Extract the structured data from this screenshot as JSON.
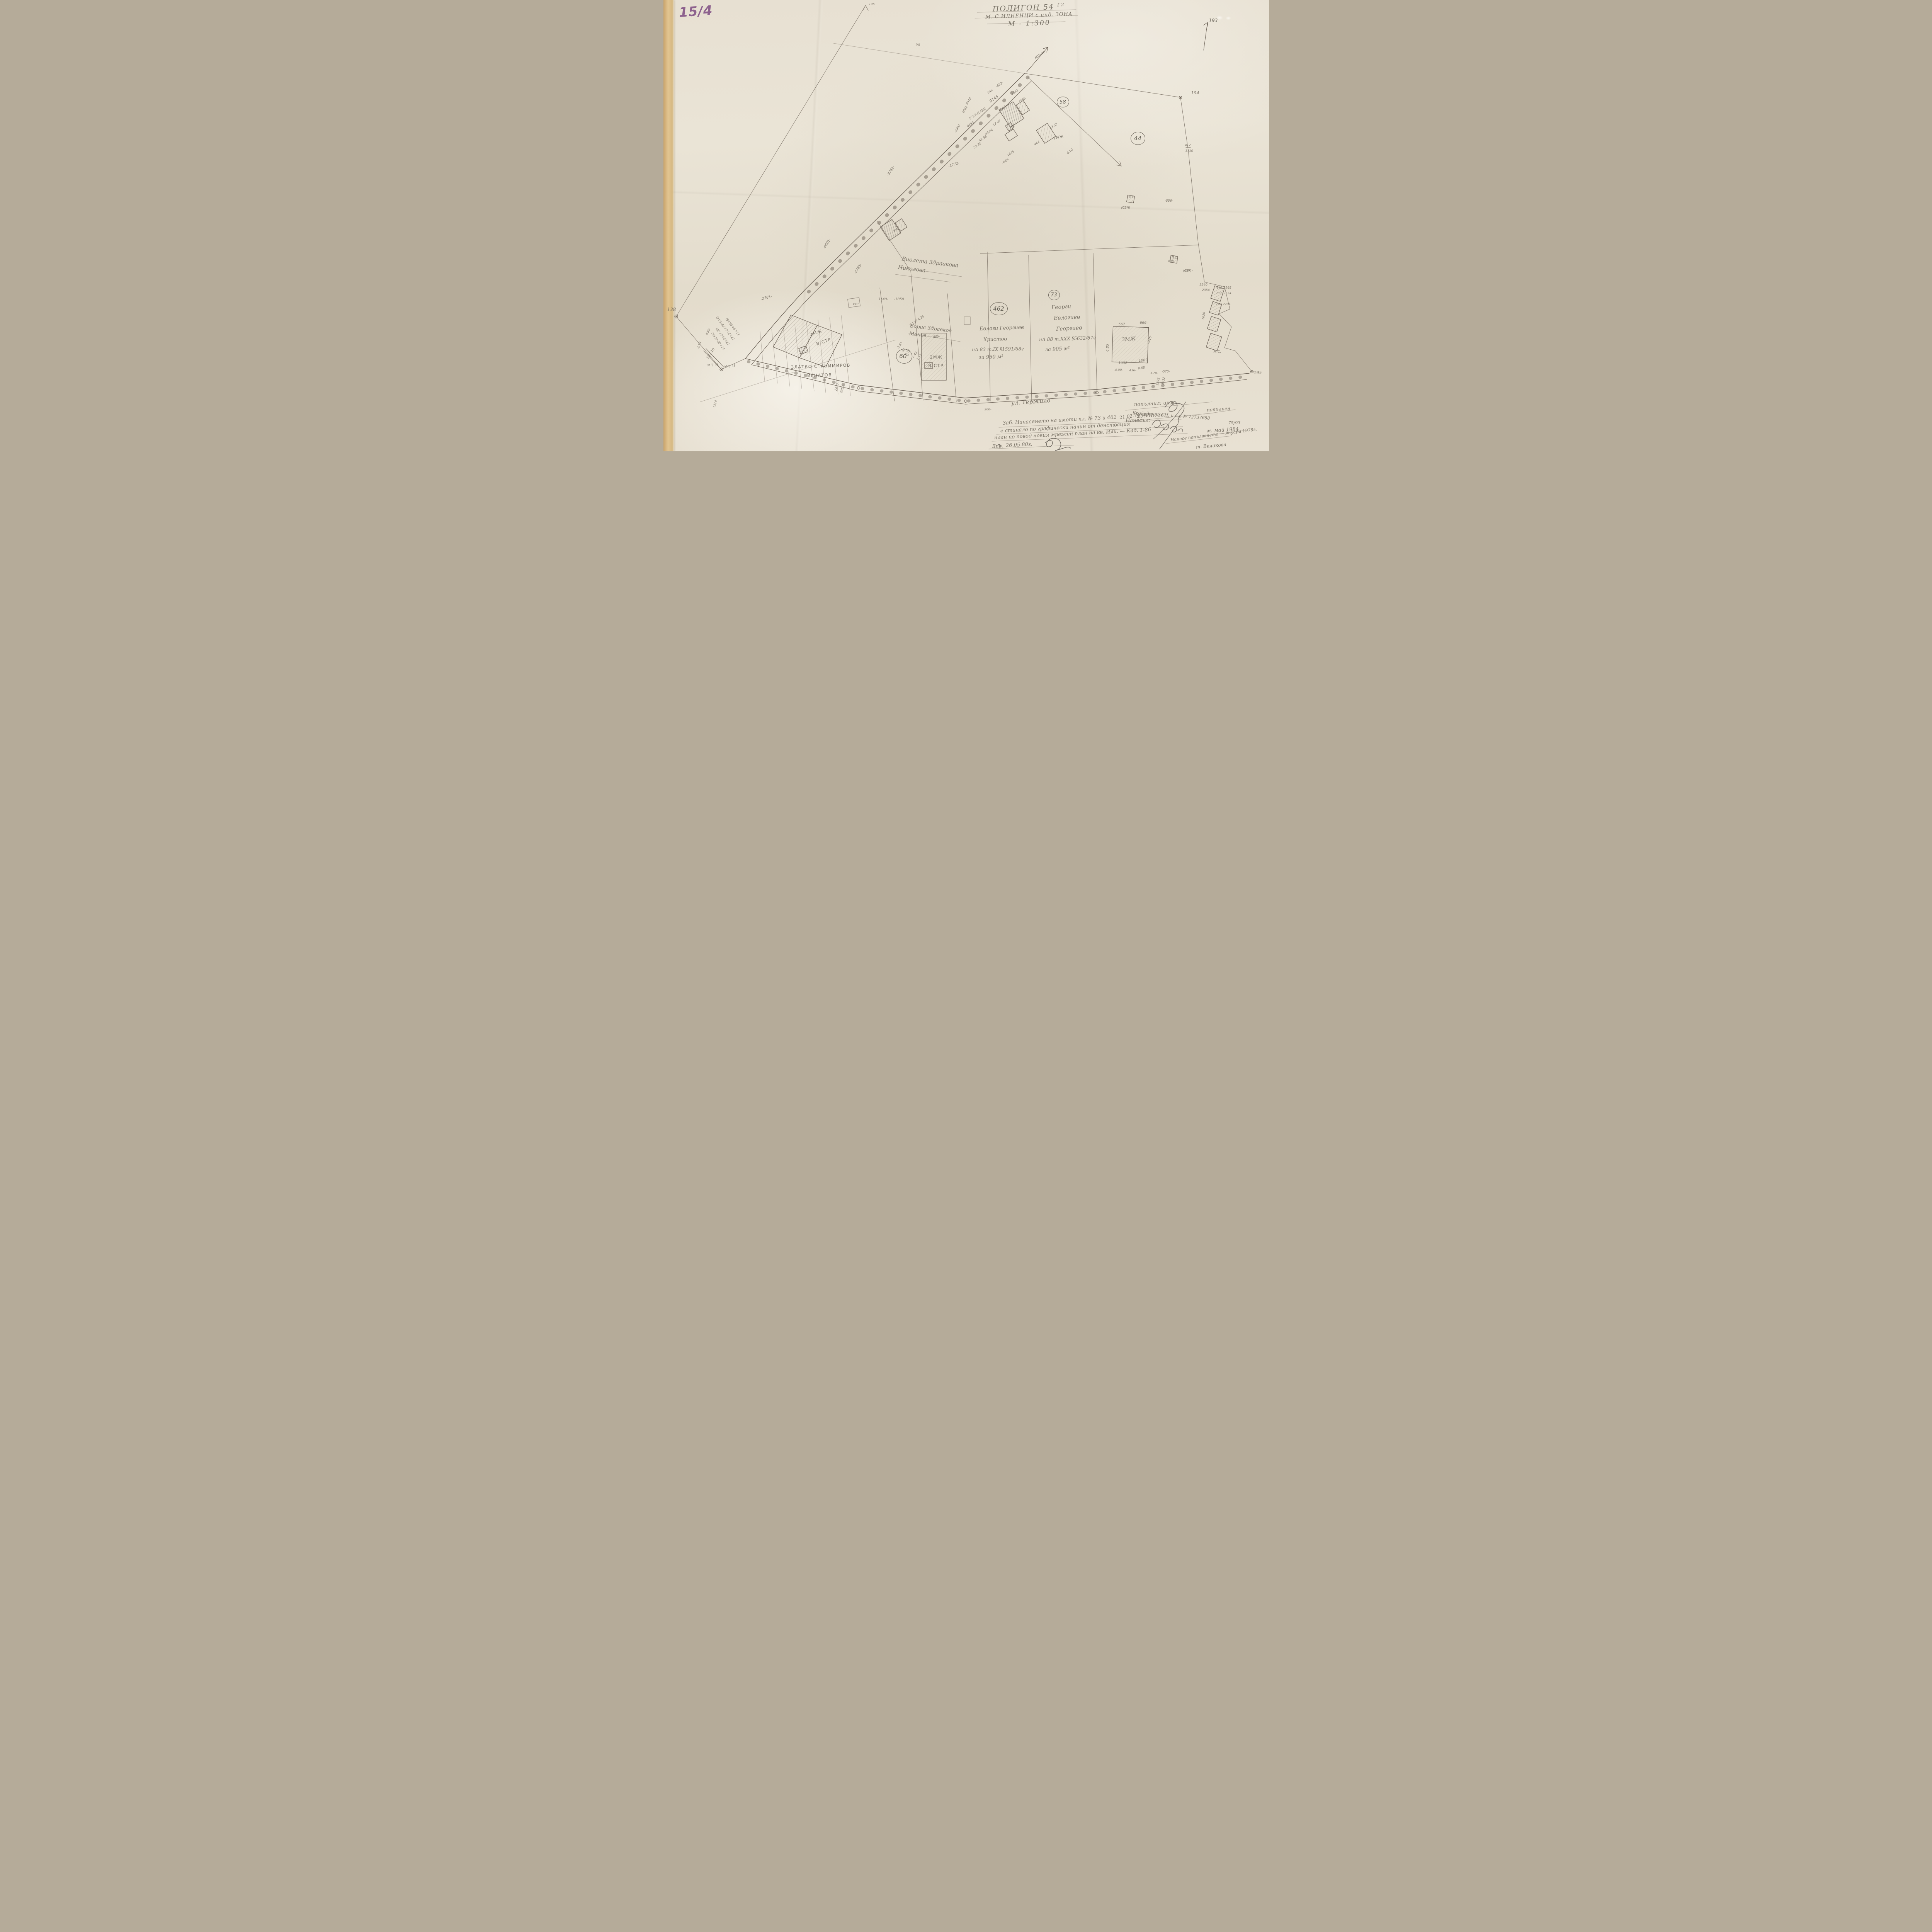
{
  "corner_stamp": {
    "text": "15/4"
  },
  "title_block": {
    "line1": "ПОЛИГОН 54",
    "line1_sup": "Г2",
    "line2": "М. С ИЛИЕНЦИ с инд. ЗОНА",
    "line3": "М - 1:300"
  },
  "survey_points": {
    "top_right": "193",
    "right": "194",
    "bottom_right": "195",
    "left": "138",
    "mt_a": "МТ II",
    "mt_b": "МТ II",
    "road_label": "мтло"
  },
  "parcel_numbers": {
    "p58": "58",
    "p44": "44",
    "p462": "462",
    "p73": "73",
    "p60a": "60",
    "p60a_sup": "а"
  },
  "owners": {
    "violeta_line1": "Виолета Здравкова",
    "violeta_line2": "Николова",
    "boris_line1": "Борис Здравков",
    "boris_line2": "Манов",
    "evlogi_line1": "Евлоги Георгиев",
    "evlogi_line2": "Христов",
    "evlogi_deed": "нА 83 т.IX §1591/68г",
    "evlogi_area": "за 950 м²",
    "georgi_line1": "Георги",
    "georgi_line2": "Евлогиев",
    "georgi_line3": "Георгиев",
    "georgi_deed": "нА 88 т.XXX §5632/67г",
    "georgi_area": "за 905 м²",
    "zlatko_line1": "ЗЛАТКО СТАНИМИРОВ",
    "zlatko_line2": "ИГНАТОВ"
  },
  "buildings": {
    "b2mzh_a": "2МЖ",
    "b2mzh_a_status": "В СТР",
    "b2mzh_b": "2МЖ",
    "b2mzh_b_status": "В СТР",
    "b3mzh": "3МЖ",
    "b1mzh": "1МЖ",
    "bms": "М.С.",
    "bmc": "МС",
    "bps1": "ПС",
    "bps2": "ПС",
    "bps3": "ПС",
    "bsvn1": "(СВН)",
    "bsvn2": "(СВУ)",
    "bsvn3": "свн"
  },
  "street": {
    "label": "ул. Тержило"
  },
  "notes": {
    "filled_by": "попълнил: инж.",
    "fill_date": "23.VII.73г.",
    "cad_ref": "Крайулични СН. и пл. № 72737658",
    "cad_ref2": "75/93",
    "filled_word": "попълнен",
    "entered_by": "Нанесъл:",
    "entered_date": "м. май 1984",
    "note_line1": "Заб. Нанасянето на имоти пл. № 73 и 462",
    "note_date1": "21.02.74 год.",
    "note_line2": "е станало по графически начин от денствация",
    "note_line3": "план по повод новия мрежен план на кв. Или. — Кад. 1-86",
    "note_sign": "Дир.",
    "note_date2": "26.05.80г.",
    "update_note": "Нанесе попълването — януари 1978г.",
    "update_sign": "т. Великова"
  },
  "measurements": [
    "9145",
    "5797-(1430)",
    "0853-",
    "-1772-",
    "-3762-",
    "-9601-",
    "-2765-",
    "3140-",
    "-1850",
    "-3783-",
    "1591",
    "1595",
    "1043",
    "17.97",
    "49.64",
    "49.98",
    "52.35",
    "-665-",
    "1645",
    "444",
    "13.33",
    "6.10",
    "-652-",
    "649",
    "5940",
    "4022",
    "-1893-",
    "412",
    "1710",
    "90",
    "196",
    "-805-",
    "8.15 / 4.25",
    "3.83",
    "87",
    "0.75",
    "1.43",
    "1.15",
    "567",
    "-666-",
    "6.85",
    "-945-",
    "1032",
    "1003",
    "-4.00-",
    "436-",
    "9.68",
    "3.78-",
    "2340",
    "2354",
    "842  2968",
    "838  2734",
    "747  2284",
    "1620",
    "-581-",
    "408",
    "-556-",
    "183.10",
    "174.00-(2.62)",
    "173.85-(4.90)",
    "172.37-(4.78·5.14)",
    "170.94-(0.16)",
    "1392",
    "1732",
    "2435-",
    "2350-",
    "-555-",
    "4.73",
    "1314",
    "200-",
    "-570-"
  ]
}
